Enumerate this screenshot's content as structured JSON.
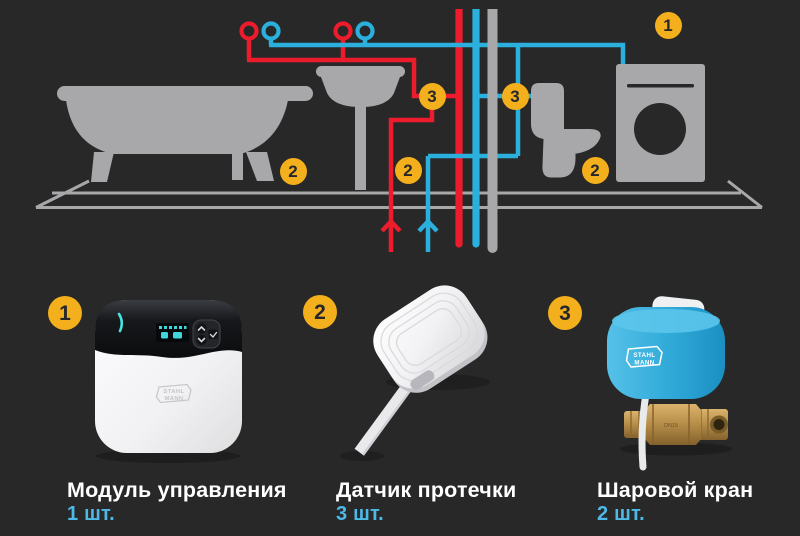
{
  "colors": {
    "background": "#282828",
    "fixture": "#a8a8ab",
    "hot": "#ec1c2c",
    "cold": "#2bb0dd",
    "badge": "#f3b01c",
    "badge_text": "#26262c",
    "qty_text": "#4db9e7",
    "name_text": "#ffffff"
  },
  "diagram": {
    "fixtures": [
      "bathtub-icon",
      "pedestal-sink-icon",
      "toilet-icon",
      "washing-machine-icon",
      "hot-water-pipe",
      "cold-water-pipe",
      "riser-pipe",
      "floor-line",
      "shutoff-valve-icon",
      "flow-arrow-icon"
    ],
    "badges": [
      {
        "label": "1",
        "location": "washing-machine-area"
      },
      {
        "label": "2",
        "location": "bathtub-floor"
      },
      {
        "label": "2",
        "location": "center-floor"
      },
      {
        "label": "2",
        "location": "toilet-floor"
      },
      {
        "label": "3",
        "location": "hot-riser-valve"
      },
      {
        "label": "3",
        "location": "cold-riser-valve"
      }
    ]
  },
  "products": [
    {
      "number": "1",
      "name": "Модуль управления",
      "qty": "1 шт."
    },
    {
      "number": "2",
      "name": "Датчик протечки",
      "qty": "3 шт."
    },
    {
      "number": "3",
      "name": "Шаровой кран",
      "qty": "2 шт."
    }
  ],
  "brand": {
    "line1": "STAHL",
    "line2": "MANN"
  },
  "valve_marking": "DN15"
}
